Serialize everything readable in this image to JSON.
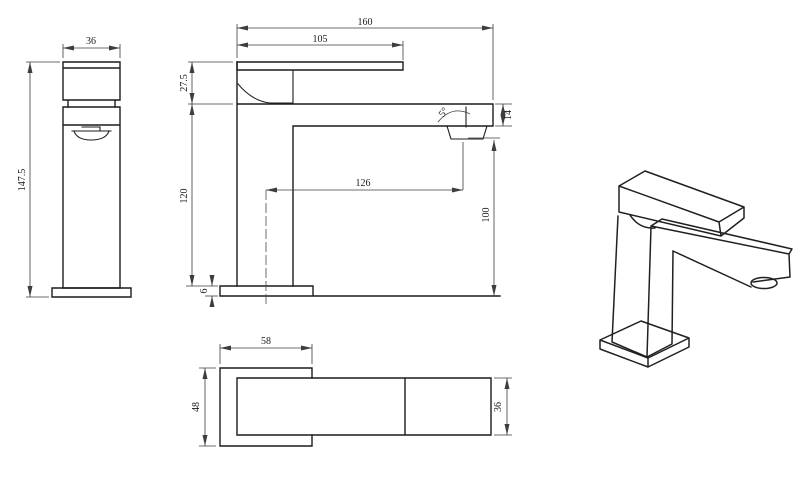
{
  "drawing": {
    "type": "technical-dimension-drawing",
    "subject": "square single-lever basin mixer tap",
    "colors": {
      "background": "#ffffff",
      "part_line": "#1c1c1c",
      "dimension_line": "#3d3d3d",
      "text": "#1b1b1b"
    },
    "dimensions": {
      "side_view": {
        "width": "36",
        "height": "147.5"
      },
      "front_view": {
        "total_length": "160",
        "handle_length": "105",
        "handle_height": "27.5",
        "aerator_angle": "5°",
        "spout_tip_height": "14",
        "spout_reach": "126",
        "outlet_height": "100",
        "body_height": "120",
        "base_thickness": "6"
      },
      "top_view": {
        "base_width": "58",
        "base_depth": "48",
        "handle_width": "36"
      }
    }
  }
}
